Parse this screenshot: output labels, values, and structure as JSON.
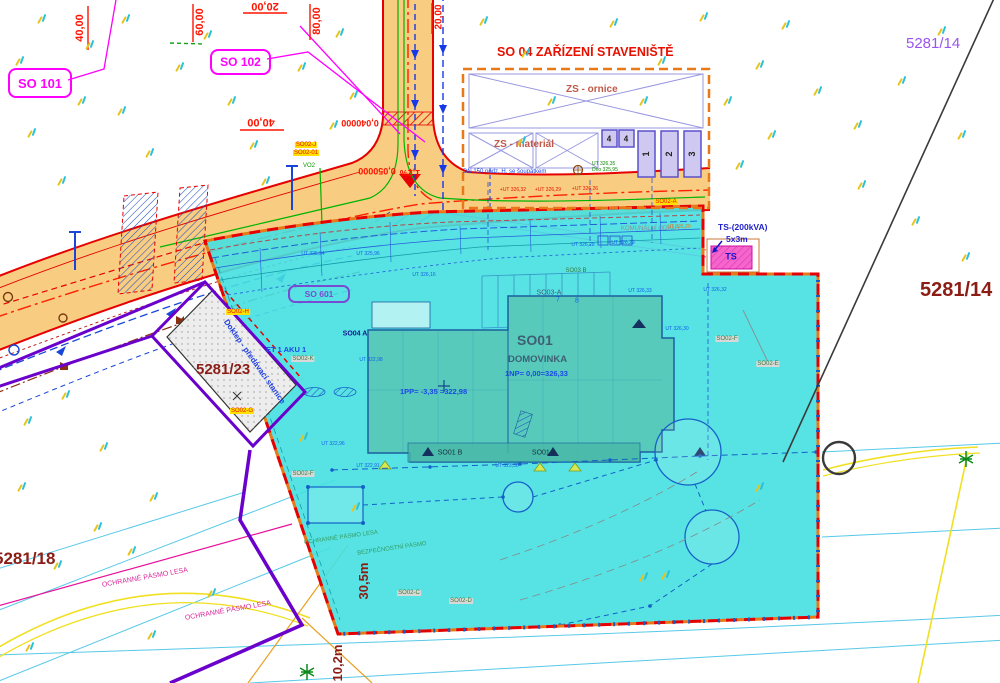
{
  "colors": {
    "road_fill": "#f8cd82",
    "road_edge": "#e60000",
    "cyan_area": "#45e0e1",
    "building": "#58cabc",
    "boundary_orange": "#e87818",
    "boundary_red": "#e60000",
    "violet": "#6a00cc",
    "magenta": "#ff00ff",
    "parcel_dark_red": "#8b1d15",
    "parcel_purple": "#9a55ee",
    "blue_note": "#1a49e6",
    "green_util": "#00b400"
  },
  "parcels": {
    "p14_top": "5281/14",
    "p14_right": "5281/14",
    "p23": "5281/23",
    "p18": "5281/18"
  },
  "objects": {
    "so101": "SO 101",
    "so102": "SO 102",
    "so601": "SO 601",
    "so01": "SO01",
    "so01_name": "DOMOVINKA",
    "np1": "1NP=  0,00=326,33",
    "pp1": "1PP= -3,35 =322,98",
    "so01a": "SO01 A",
    "so01b": "SO01 B",
    "so03a": "SO03-A",
    "so04a": "SO04 A",
    "et_aku": "ET 1 AKU 1",
    "doklep": "Doklep - předávací stanice"
  },
  "site_facility": {
    "title": "SO 04 ZAŘÍZENÍ STAVENIŠTĚ",
    "ornice": "ZS - ornice",
    "material": "ZS - materiál",
    "note": "DN 150 podz. H. se šoupátkem",
    "ut": "UT 326,35",
    "dno": "Dno 325,95"
  },
  "ts": {
    "l1": "TS-(200kVA)",
    "l2": "5x3m",
    "label": "TS"
  },
  "zones": {
    "forest1": "OCHRANNÉ PÁSMO LESA",
    "forest2": "OCHRANNÉ PÁSMO LESA",
    "forest3": "OCHRANNÉ PÁSMO LESA",
    "safety": "BEZPEČNOSTNÍ PÁSMO",
    "waste": "KOMUNÁLNÍ ODPAD"
  },
  "dims": {
    "d1": "30,5m",
    "d2": "10,2m"
  },
  "stations": [
    {
      "t": "40,00",
      "x": 80,
      "y": 28,
      "r": -90,
      "s": 11
    },
    {
      "t": "60,00",
      "x": 200,
      "y": 22,
      "r": -90,
      "s": 11
    },
    {
      "t": "20,00",
      "x": 265,
      "y": 6,
      "r": 180,
      "s": 11
    },
    {
      "t": "80,00",
      "x": 317,
      "y": 21,
      "r": -90,
      "s": 11
    },
    {
      "t": "40,00",
      "x": 261,
      "y": 122,
      "r": 180,
      "s": 11
    },
    {
      "t": "20,00",
      "x": 439,
      "y": 17,
      "r": -90,
      "s": 10
    },
    {
      "t": "0,040000",
      "x": 360,
      "y": 123,
      "r": 180,
      "s": 9
    },
    {
      "t": "0,050000",
      "x": 377,
      "y": 171,
      "r": 180,
      "s": 9
    },
    {
      "t": "1,2%",
      "x": 410,
      "y": 173,
      "r": 180,
      "s": 9
    }
  ],
  "elevations": [
    {
      "t": "UT 325,94",
      "x": 313,
      "y": 254
    },
    {
      "t": "UT 325,96",
      "x": 368,
      "y": 254
    },
    {
      "t": "UT 326,16",
      "x": 424,
      "y": 275
    },
    {
      "t": "UT 326,28",
      "x": 583,
      "y": 245
    },
    {
      "t": "UT 326,29",
      "x": 623,
      "y": 243
    },
    {
      "t": "UT 326,20",
      "x": 679,
      "y": 227,
      "c": "#e07818"
    },
    {
      "t": "UT 326,32",
      "x": 715,
      "y": 290
    },
    {
      "t": "UT 326,33",
      "x": 640,
      "y": 291
    },
    {
      "t": "UT 326,30",
      "x": 677,
      "y": 329
    },
    {
      "t": "UT 322,98",
      "x": 371,
      "y": 360
    },
    {
      "t": "UT 322,96",
      "x": 333,
      "y": 444
    },
    {
      "t": "UT 322,91",
      "x": 368,
      "y": 466
    },
    {
      "t": "UT 323,30",
      "x": 507,
      "y": 466
    },
    {
      "t": "+UT 326,32",
      "x": 513,
      "y": 190,
      "c": "#e81000"
    },
    {
      "t": "+UT 326,29",
      "x": 548,
      "y": 190,
      "c": "#e81000"
    },
    {
      "t": "+UT 326,26",
      "x": 585,
      "y": 189,
      "c": "#e81000"
    }
  ],
  "refs": [
    {
      "t": "SO02-J",
      "x": 306,
      "y": 145,
      "bg": "#ffe000",
      "c": "#e81000"
    },
    {
      "t": "SO02-01",
      "x": 306,
      "y": 153,
      "bg": "#ffe000",
      "c": "#e81000"
    },
    {
      "t": "SO02-A",
      "x": 666,
      "y": 202,
      "bg": "#ffe000",
      "c": "#e81000"
    },
    {
      "t": "SO02-H",
      "x": 238,
      "y": 312,
      "bg": "#ffe000",
      "c": "#e81000"
    },
    {
      "t": "SO02-G",
      "x": 242,
      "y": 411,
      "bg": "#ffe000",
      "c": "#e81000"
    },
    {
      "t": "SO02-K",
      "x": 303,
      "y": 359,
      "bg": "#d8d8d8",
      "c": "#3a7a3a"
    },
    {
      "t": "SO02-F",
      "x": 303,
      "y": 474,
      "bg": "#d8d8d8",
      "c": "#3a7a3a"
    },
    {
      "t": "SO02-F",
      "x": 727,
      "y": 339,
      "bg": "#d8d8d8",
      "c": "#3a7a3a"
    },
    {
      "t": "SO02-E",
      "x": 768,
      "y": 364,
      "bg": "#d8d8d8",
      "c": "#3a7a3a"
    },
    {
      "t": "SO02-C",
      "x": 409,
      "y": 593,
      "bg": "#d8d8d8",
      "c": "#3a7a3a"
    },
    {
      "t": "SO02-D",
      "x": 461,
      "y": 601,
      "bg": "#d8d8d8",
      "c": "#3a7a3a"
    },
    {
      "t": "SO03 B",
      "x": 576,
      "y": 271,
      "c": "#3a7a3a"
    },
    {
      "t": "VO2",
      "x": 309,
      "y": 166,
      "c": "#0a9a00"
    },
    {
      "t": "7",
      "x": 558,
      "y": 300,
      "c": "#1560e8",
      "s": 7
    },
    {
      "t": "8",
      "x": 577,
      "y": 301,
      "c": "#1560e8",
      "s": 7
    },
    {
      "t": "4",
      "x": 609,
      "y": 139,
      "c": "#222222",
      "s": 8,
      "b": 1
    },
    {
      "t": "4",
      "x": 626,
      "y": 139,
      "c": "#222222",
      "s": 8,
      "b": 1
    },
    {
      "t": "1",
      "x": 646,
      "y": 154,
      "c": "#222222",
      "s": 9,
      "b": 1,
      "r": -90
    },
    {
      "t": "2",
      "x": 669,
      "y": 154,
      "c": "#222222",
      "s": 9,
      "b": 1,
      "r": -90
    },
    {
      "t": "3",
      "x": 692,
      "y": 154,
      "c": "#222222",
      "s": 9,
      "b": 1,
      "r": -90
    }
  ],
  "vegetation": [
    [
      38,
      14
    ],
    [
      86,
      40
    ],
    [
      122,
      14
    ],
    [
      16,
      56
    ],
    [
      78,
      96
    ],
    [
      28,
      128
    ],
    [
      118,
      106
    ],
    [
      176,
      62
    ],
    [
      146,
      148
    ],
    [
      58,
      176
    ],
    [
      228,
      96
    ],
    [
      250,
      140
    ],
    [
      204,
      30
    ],
    [
      298,
      62
    ],
    [
      336,
      28
    ],
    [
      262,
      176
    ],
    [
      330,
      120
    ],
    [
      350,
      90
    ],
    [
      480,
      16
    ],
    [
      522,
      48
    ],
    [
      548,
      96
    ],
    [
      518,
      136
    ],
    [
      610,
      18
    ],
    [
      658,
      56
    ],
    [
      700,
      12
    ],
    [
      724,
      96
    ],
    [
      756,
      60
    ],
    [
      782,
      20
    ],
    [
      814,
      86
    ],
    [
      854,
      120
    ],
    [
      898,
      76
    ],
    [
      938,
      26
    ],
    [
      958,
      130
    ],
    [
      858,
      180
    ],
    [
      912,
      216
    ],
    [
      962,
      252
    ],
    [
      768,
      130
    ],
    [
      640,
      96
    ],
    [
      736,
      160
    ],
    [
      24,
      416
    ],
    [
      62,
      390
    ],
    [
      100,
      442
    ],
    [
      18,
      482
    ],
    [
      94,
      522
    ],
    [
      150,
      492
    ],
    [
      54,
      560
    ],
    [
      128,
      546
    ],
    [
      26,
      642
    ],
    [
      148,
      630
    ],
    [
      208,
      588
    ],
    [
      300,
      432
    ],
    [
      352,
      502
    ],
    [
      640,
      572
    ],
    [
      662,
      570
    ],
    [
      756,
      482
    ]
  ]
}
